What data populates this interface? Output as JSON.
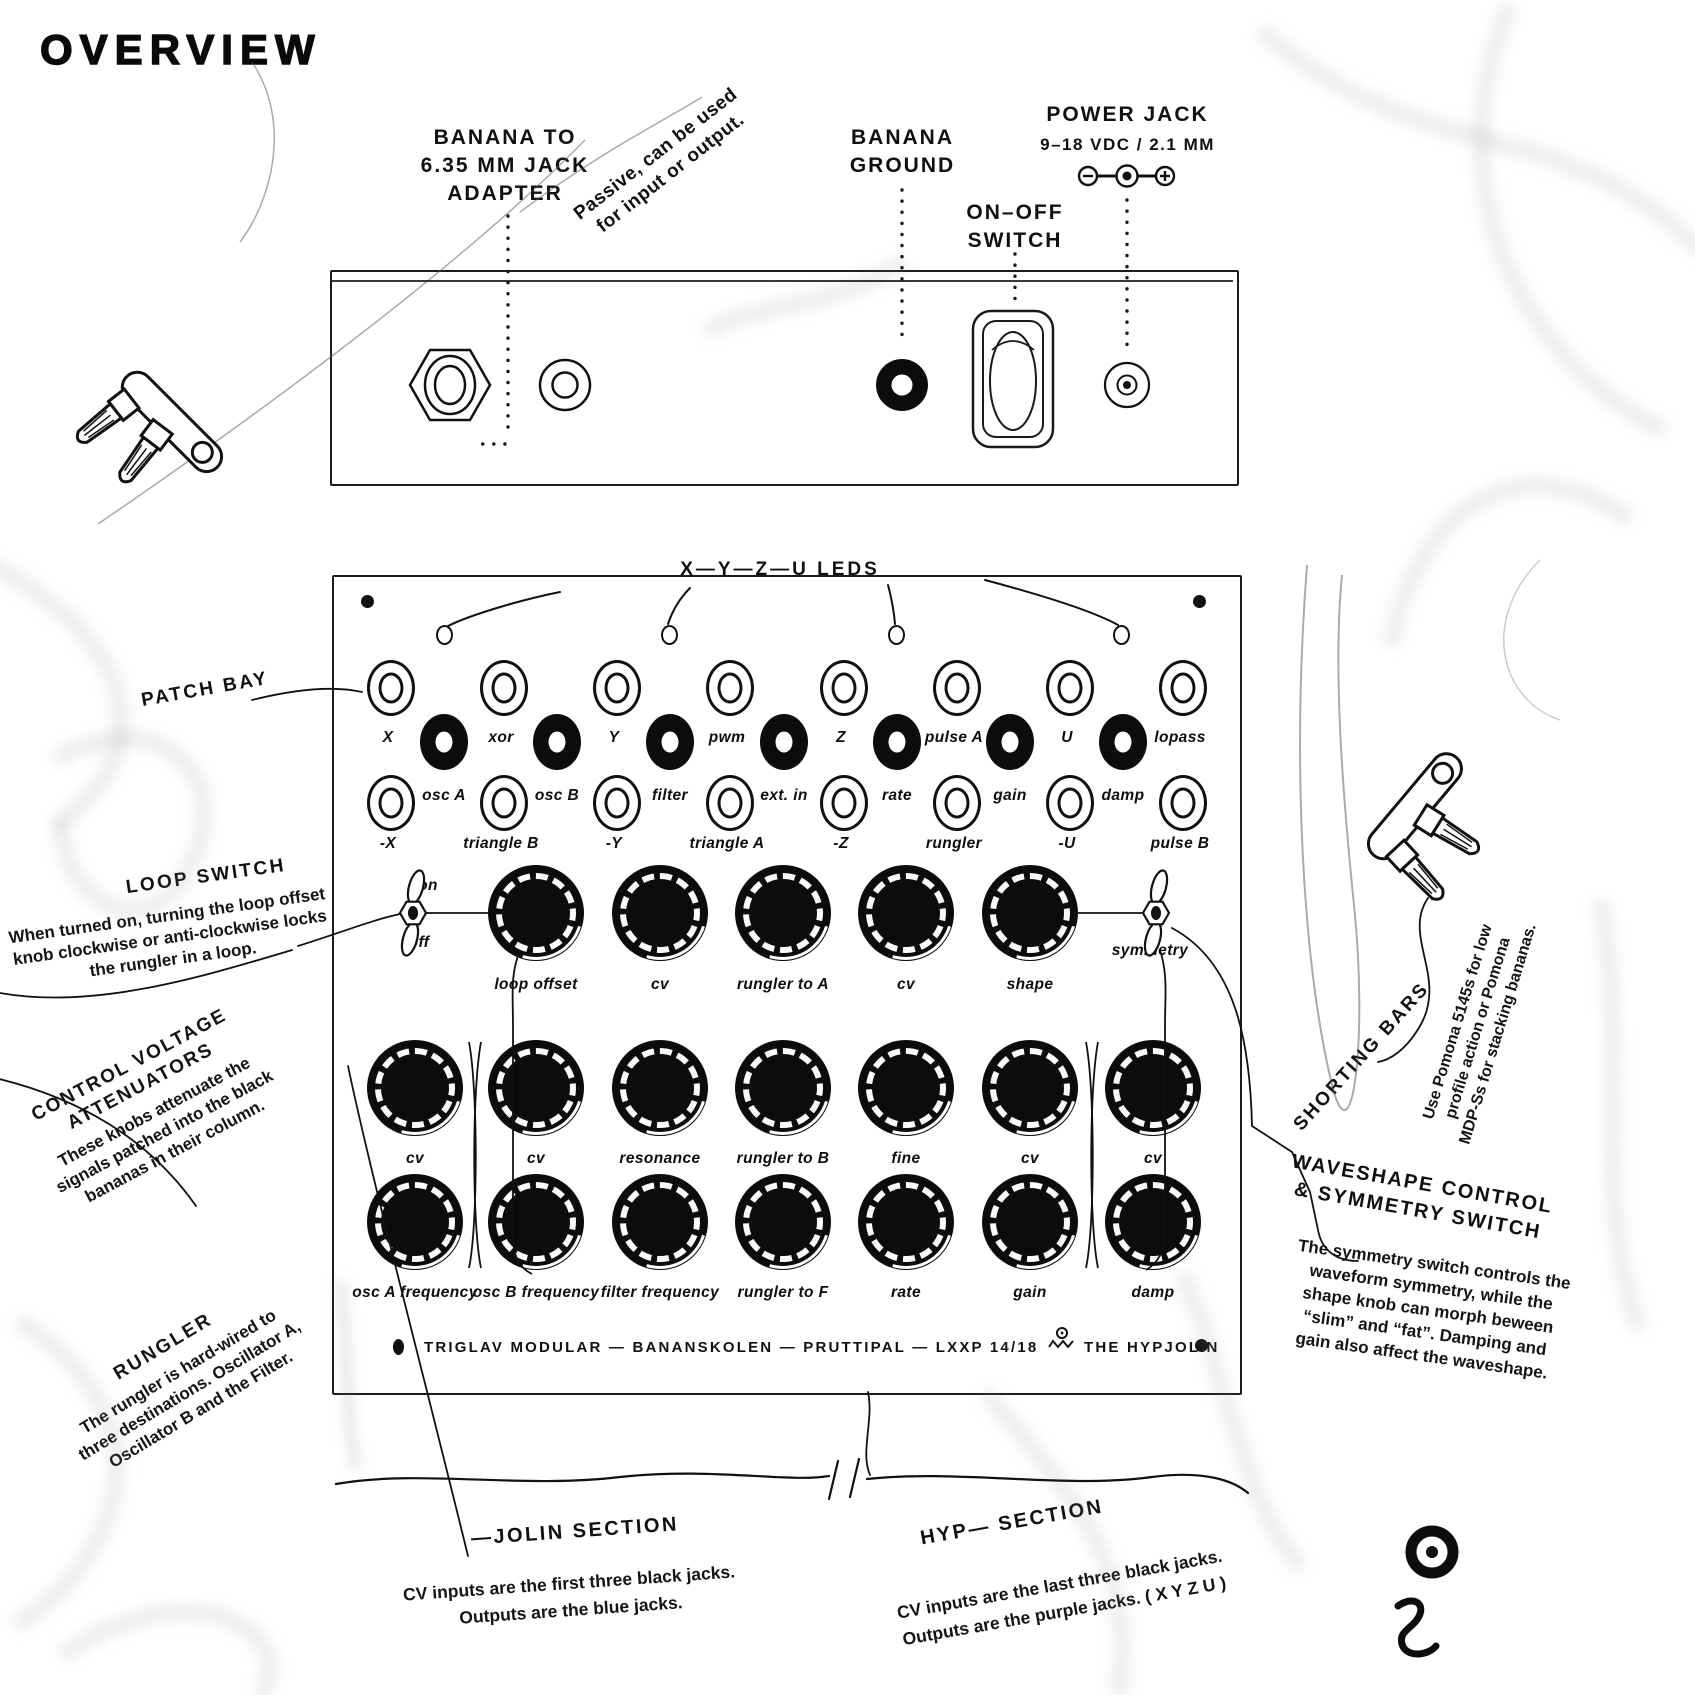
{
  "title": "OVERVIEW",
  "top_panel": {
    "adapter_label": [
      "BANANA TO",
      "6.35 MM JACK",
      "ADAPTER"
    ],
    "adapter_note": [
      "Passive, can be used",
      "for input or output."
    ],
    "ground_label": [
      "BANANA",
      "GROUND"
    ],
    "switch_label": [
      "ON–OFF",
      "SWITCH"
    ],
    "power_label": "POWER JACK",
    "power_sub": "9–18 VDC / 2.1 MM"
  },
  "leds_label": "X—Y—Z—U LEDS",
  "patch_bay": {
    "row1": [
      "X",
      "xor",
      "Y",
      "pwm",
      "Z",
      "pulse A",
      "U",
      "lopass"
    ],
    "row2": [
      "osc A",
      "osc B",
      "filter",
      "ext. in",
      "rate",
      "gain",
      "damp"
    ],
    "row3": [
      "-X",
      "triangle B",
      "-Y",
      "triangle A",
      "-Z",
      "rungler",
      "-U",
      "pulse B"
    ]
  },
  "knobs": {
    "row1": [
      "loop offset",
      "cv",
      "rungler to A",
      "cv",
      "shape"
    ],
    "row2": [
      "cv",
      "cv",
      "resonance",
      "rungler to B",
      "fine",
      "cv",
      "cv"
    ],
    "row3": [
      "osc A frequency",
      "osc B frequency",
      "filter frequency",
      "rungler to F",
      "rate",
      "gain",
      "damp"
    ]
  },
  "switches": {
    "on": "on",
    "off": "off",
    "symmetry": "symmetry"
  },
  "footer": {
    "brand": "TRIGLAV MODULAR — BANANSKOLEN — PRUTTIPAL — LXXP 14/18",
    "product": "THE HYPJOLIN"
  },
  "annotations": {
    "patch_bay": "PATCH BAY",
    "loop_switch": {
      "title": "LOOP SWITCH",
      "body": [
        "When turned on, turning the loop offset",
        "knob clockwise or anti-clockwise locks",
        "the rungler in a loop."
      ]
    },
    "cv_attenuators": {
      "title": [
        "CONTROL VOLTAGE",
        "ATTENUATORS"
      ],
      "body": [
        "These knobs attenuate the",
        "signals patched into the black",
        "bananas in their column."
      ]
    },
    "rungler": {
      "title": "RUNGLER",
      "body": [
        "The rungler is hard-wired to",
        "three destinations. Oscillator A,",
        "Oscillator B and the Filter."
      ]
    },
    "shorting_bars": {
      "title": "SHORTING BARS",
      "body": [
        "Use Pomona 5145s for low",
        "profile action or Pomona",
        "MDP-Ss for stacking bananas."
      ]
    },
    "waveshape": {
      "title": [
        "WAVESHAPE CONTROL",
        "& SYMMETRY SWITCH"
      ],
      "body": [
        "The symmetry switch controls the",
        "waveform symmetry, while the",
        "shape knob can morph beween",
        "“slim” and “fat”. Damping and",
        "gain also affect the waveshape."
      ]
    },
    "jolin_section": {
      "title": "—JOLIN SECTION",
      "body": [
        "CV inputs are the first three black jacks.",
        "Outputs are the blue jacks."
      ]
    },
    "hyp_section": {
      "title": "HYP— SECTION",
      "body": [
        "CV inputs are the last three black jacks.",
        "Outputs are the purple jacks. ( X Y Z U )"
      ]
    }
  }
}
